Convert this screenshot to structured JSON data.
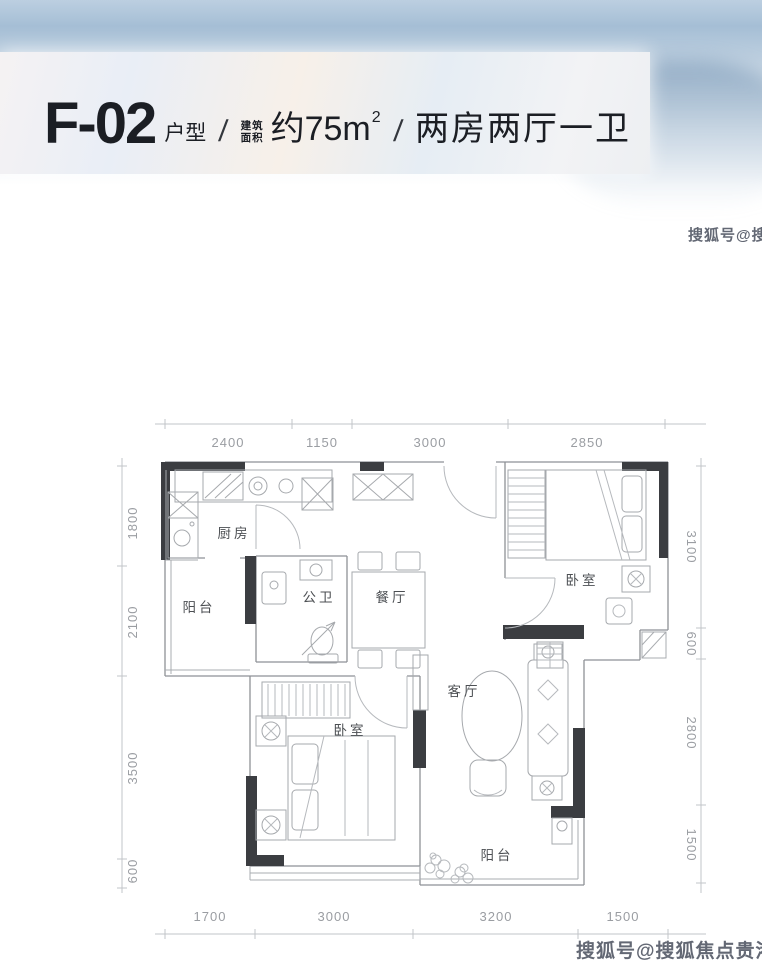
{
  "header": {
    "unit_code": "F-02",
    "unit_type_label": "户型",
    "slash1": "/",
    "slash2": "/",
    "area_prefix_line1": "建筑",
    "area_prefix_line2": "面积",
    "area_value": "约75m",
    "area_superscript": "2",
    "layout_label": "两房两厅一卫"
  },
  "watermarks": {
    "side": "搜狐号@搜狐焦点贵港站",
    "bottom": "搜狐号@搜狐焦点贵港站"
  },
  "plan": {
    "rooms": {
      "kitchen": "厨房",
      "balcony_left": "阳台",
      "bath": "公卫",
      "dining": "餐厅",
      "bedroom_right": "卧室",
      "living": "客厅",
      "bedroom_left": "卧室",
      "balcony_bottom": "阳台"
    },
    "dims": {
      "top": [
        "2400",
        "1150",
        "3000",
        "2850"
      ],
      "left": [
        "1800",
        "2100",
        "3500",
        "600"
      ],
      "right": [
        "3100",
        "600",
        "2800",
        "1500"
      ],
      "bottom": [
        "1700",
        "3000",
        "3200",
        "1500"
      ]
    }
  }
}
